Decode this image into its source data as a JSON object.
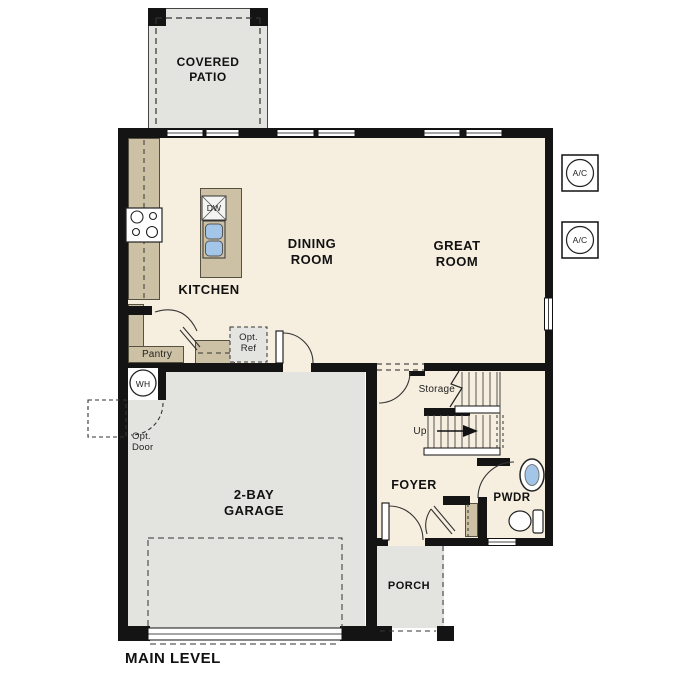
{
  "title": {
    "text": "MAIN LEVEL"
  },
  "rooms": {
    "covered_patio": {
      "name": "COVERED PATIO"
    },
    "kitchen": {
      "name": "KITCHEN"
    },
    "dining_room": {
      "name": "DINING ROOM"
    },
    "great_room": {
      "name": "GREAT ROOM"
    },
    "garage": {
      "name": "2-BAY GARAGE"
    },
    "foyer": {
      "name": "FOYER"
    },
    "powder_room": {
      "name": "PWDR"
    },
    "porch": {
      "name": "PORCH"
    }
  },
  "annotations": {
    "pantry": "Pantry",
    "storage": "Storage",
    "stairs_up": "Up",
    "optional_refrigerator": {
      "line1": "Opt.",
      "line2": "Ref"
    },
    "optional_door": {
      "line1": "Opt.",
      "line2": "Door"
    },
    "water_heater": "WH",
    "air_conditioner": "A/C",
    "dishwasher": "DW"
  },
  "colors": {
    "floor_cream": "#f6efdf",
    "outdoor_gray": "#e3e3e0",
    "counter_tan": "#cdc1a5",
    "wall_black": "#141414",
    "sink_blue": "#a3c6e8"
  }
}
